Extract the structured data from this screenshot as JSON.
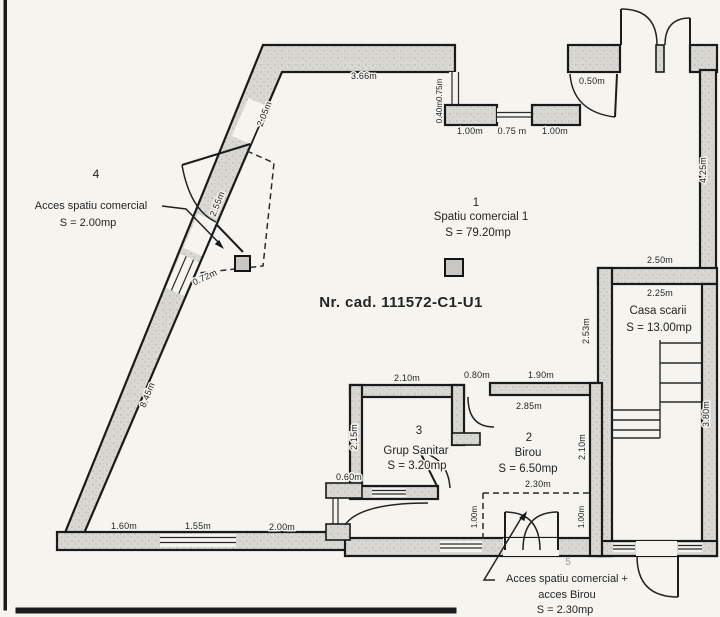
{
  "document": {
    "cad_label": "Nr. cad. 111572-C1-U1"
  },
  "rooms": {
    "r1": {
      "num": "1",
      "name": "Spatiu comercial 1",
      "area": "S = 79.20mp"
    },
    "r2": {
      "num": "2",
      "name": "Birou",
      "area": "S = 6.50mp"
    },
    "r3": {
      "num": "3",
      "name": "Grup Sanitar",
      "area": "S = 3.20mp"
    },
    "stair": {
      "name": "Casa scarii",
      "area": "S = 13.00mp"
    }
  },
  "annotations": {
    "a4": {
      "num": "4",
      "line1": "Acces spatiu comercial",
      "area": "S = 2.00mp"
    },
    "a5": {
      "num": "5",
      "line1": "Acces spatiu comercial +",
      "line2": "acces Birou",
      "area": "S = 2.30mp"
    }
  },
  "dims": {
    "top_wall": "3.66m",
    "slant_upper": "2.05m",
    "recess_jog": "0.40m0.75m",
    "recess_pier1": "1.00m",
    "recess_window": "0.75 m",
    "recess_pier2": "1.00m",
    "entry_pier": "0.50m",
    "right_wall": "4.25m",
    "stair_top_outer": "2.50m",
    "stair_top_inner": "2.25m",
    "stair_left": "2.53m",
    "stair_right": "3.80m",
    "access4_width": "2.55m",
    "slant_window": "0.72m",
    "slant_lower": "8.45m",
    "bottom_seg1": "1.60m",
    "bottom_seg2": "1.55m",
    "bottom_seg3": "2.00m",
    "step": "0.60m",
    "gs_top": "2.10m",
    "gs_left": "2.15m",
    "birou_door": "0.80m",
    "birou_top": "1.90m",
    "birou_inner": "2.85m",
    "birou_right": "2.10m",
    "access5_width": "2.30m",
    "access5_left": "1.00m",
    "access5_right": "1.00m"
  },
  "colors": {
    "paper": "#f5f4ef",
    "ink": "#1a1a1a",
    "wall_fill": "#d9d8d2"
  }
}
